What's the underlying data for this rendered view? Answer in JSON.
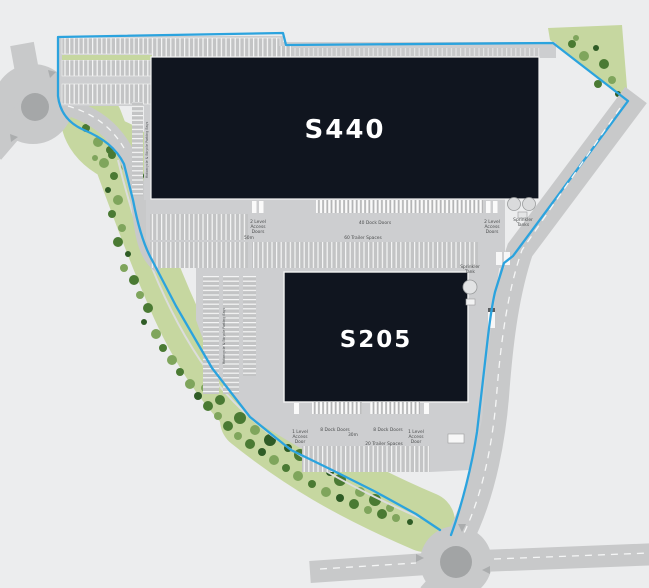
{
  "buildings": {
    "s440": {
      "name": "S440",
      "dock_doors": "40 Dock Doors",
      "trailer_spaces": "60 Trailer Spaces",
      "yard_depth": "50m",
      "access_left": [
        "2 Level",
        "Access",
        "Doors"
      ],
      "access_right": [
        "2 Level",
        "Access",
        "Doors"
      ],
      "sprinkler": [
        "Sprinkler",
        "Tanks"
      ]
    },
    "s205": {
      "name": "S205",
      "dock_doors_left": "8 Dock Doors",
      "dock_doors_right": "8 Dock Doors",
      "trailer_spaces": "20 Trailer Spaces",
      "yard_depth": "30m",
      "access_left": [
        "1 Level",
        "Access",
        "Door"
      ],
      "access_right": [
        "1 Level",
        "Access",
        "Door"
      ],
      "sprinkler": [
        "Sprinkler",
        "Tank"
      ]
    }
  },
  "parking": {
    "west_row_label": "Motorcycle & Bicycle Parking Bays",
    "south_row_label": "Motorcycle & Bicycle Parking Bays"
  },
  "colors": {
    "site_boundary": "#2BA3DE",
    "building": "#10151F",
    "landscape_green": "#C6D7A0",
    "tree_green": "#4A7A33",
    "road_gray": "#C8C9CA",
    "background": "#ECEDEE",
    "label_text": "#4B4D4E"
  }
}
